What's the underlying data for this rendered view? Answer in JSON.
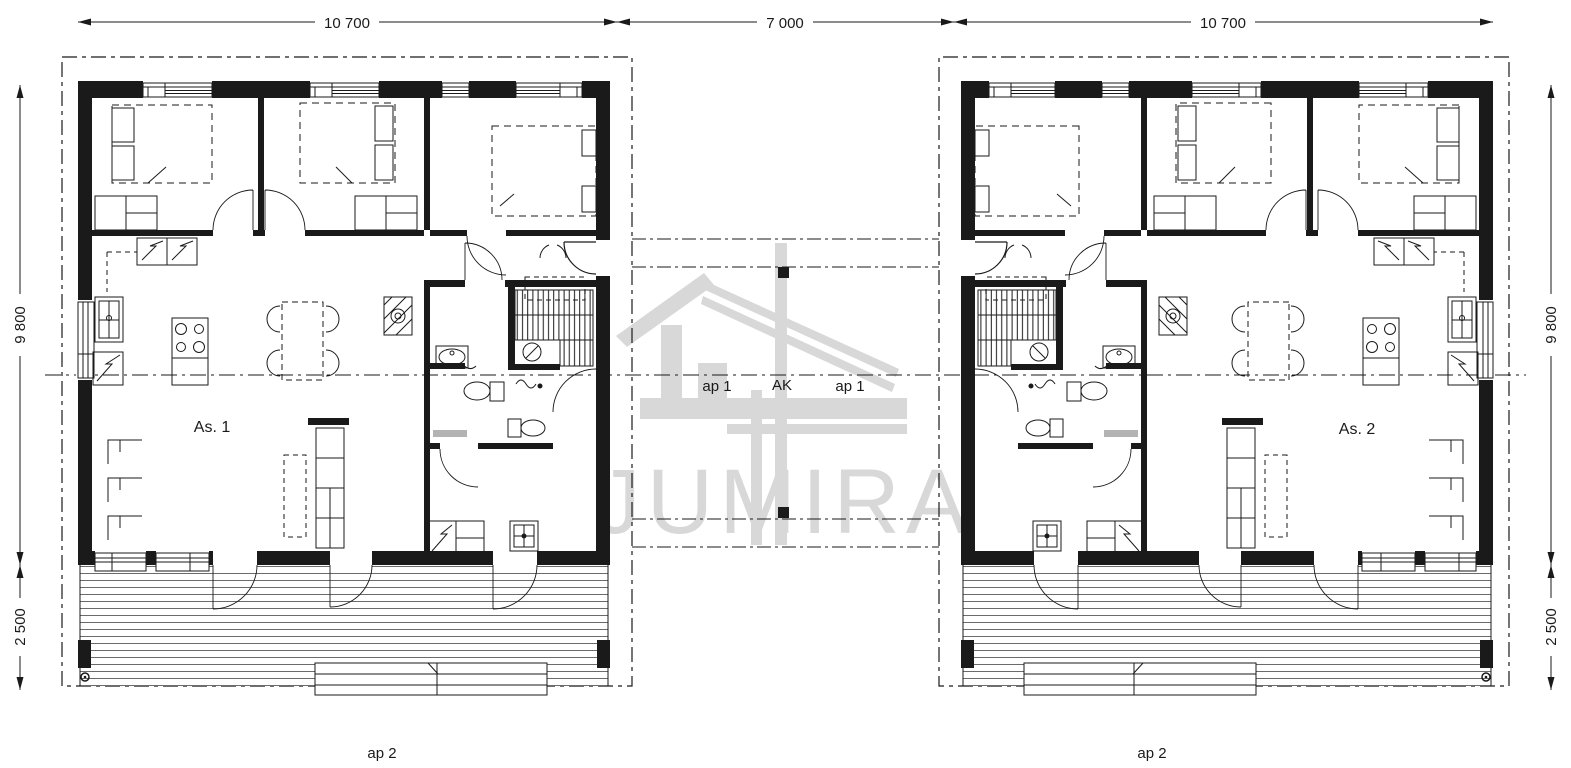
{
  "drawing": {
    "type": "floor-plan",
    "watermark": {
      "text": "JUMIRA",
      "color": "#d8d8d8"
    }
  },
  "dimensions": {
    "top": [
      "10 700",
      "7 000",
      "10 700"
    ],
    "side": [
      "9 800",
      "2 500"
    ]
  },
  "labels": {
    "apartment_1": "As. 1",
    "apartment_2": "As. 2",
    "carport_space_left": "ap 1",
    "carport": "AK",
    "carport_space_right": "ap 1",
    "parking_bottom_left": "ap 2",
    "parking_bottom_right": "ap 2"
  },
  "colors": {
    "line": "#1a1a1a",
    "watermark": "#d8d8d8",
    "background": "#ffffff",
    "deck_line": "#6b6b6b"
  }
}
